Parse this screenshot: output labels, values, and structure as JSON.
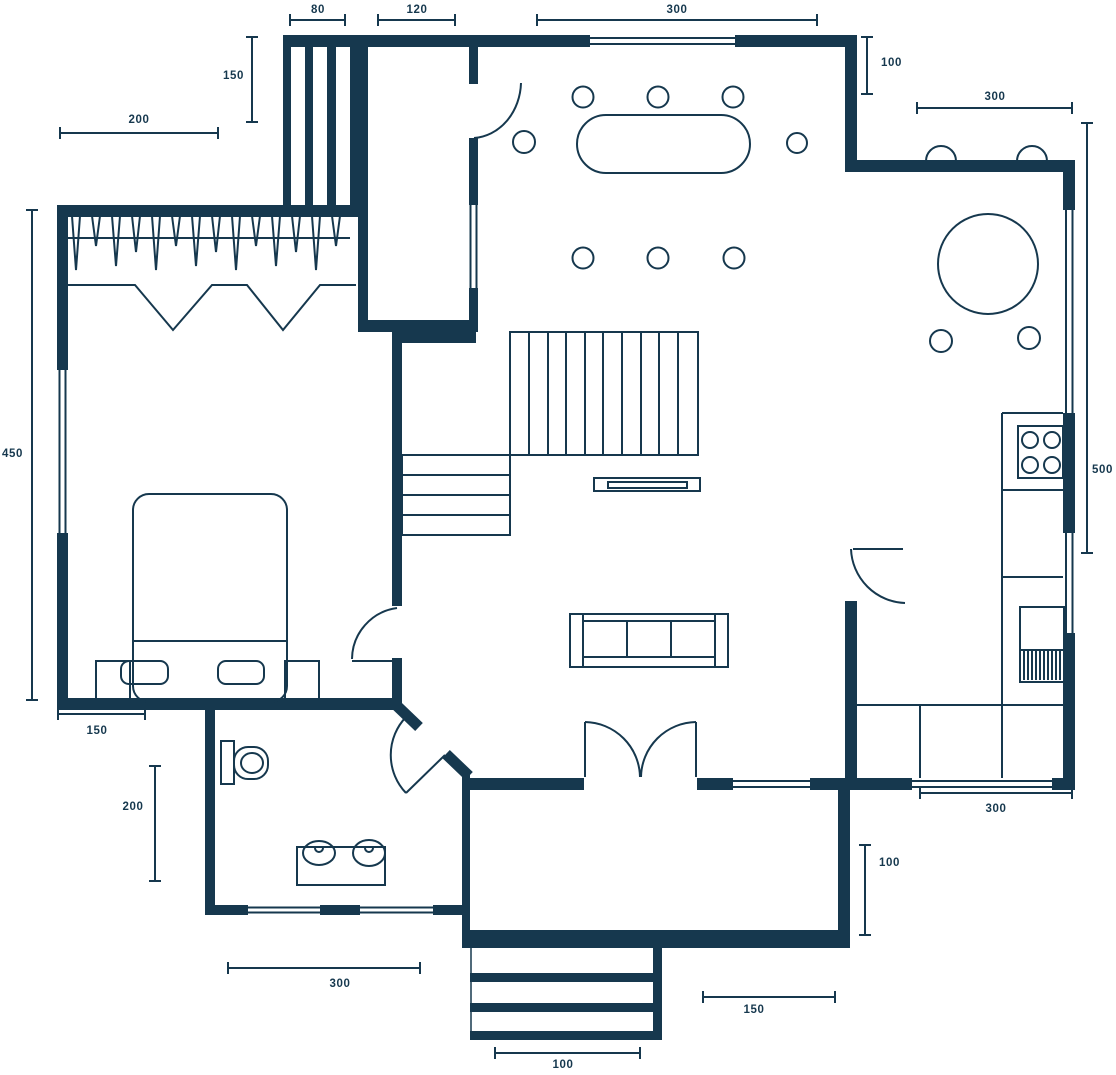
{
  "meta": {
    "type": "architectural-floor-plan",
    "units": "cm"
  },
  "theme": {
    "line_color": "#16384E",
    "background": "#FFFFFF"
  },
  "dimensions": {
    "top": {
      "d80": "80",
      "d120": "120",
      "d300": "300"
    },
    "left": {
      "d150_closet": "150",
      "d200_top": "200",
      "d450": "450",
      "d150_bed": "150",
      "d200_bath": "200"
    },
    "right": {
      "d100_top": "100",
      "d300_top": "300",
      "d500": "500",
      "d300_bottom": "300",
      "d100_bottom": "100"
    },
    "bottom": {
      "d300_bath": "300",
      "d100_porch": "100",
      "d150_entry": "150"
    }
  }
}
